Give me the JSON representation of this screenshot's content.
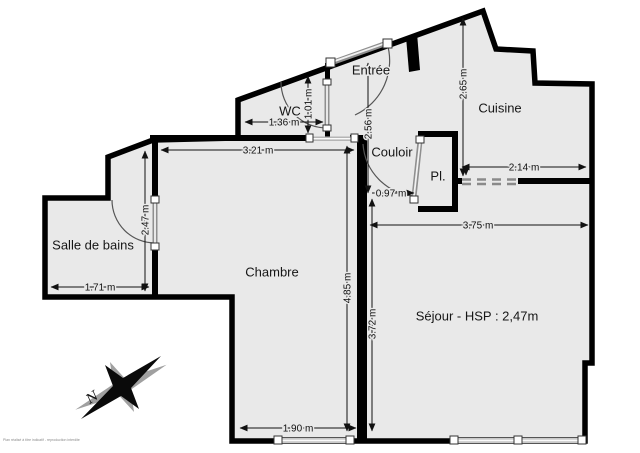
{
  "plan": {
    "rooms": {
      "wc": "WC",
      "entree": "Entrée",
      "cuisine": "Cuisine",
      "couloir": "Couloir",
      "placard": "Pl.",
      "salle_de_bains": "Salle de bains",
      "chambre": "Chambre",
      "sejour": "Séjour - HSP : 2,47m"
    },
    "dimensions": {
      "wc_width": "1.36 m",
      "wc_depth": "1.01 m",
      "entree_depth": "2.56 m",
      "couloir_width": "0.97 m",
      "chambre_top_width": "3.21 m",
      "salle_de_bains_depth": "2.47 m",
      "salle_de_bains_width": "1.71 m",
      "chambre_depth": "4.85 m",
      "sejour_depth": "3.72 m",
      "cuisine_depth": "2.65 m",
      "cuisine_width": "2.14 m",
      "sejour_width": "3.75 m",
      "chambre_bottom_width": "1.90 m"
    },
    "compass": {
      "north_label": "N"
    },
    "watermark": "Plan réalisé à titre indicatif - reproduction interdite",
    "colors": {
      "floor": "#e9e9e9",
      "wall": "#000000",
      "door_leaf": "#8f8f8f"
    }
  }
}
